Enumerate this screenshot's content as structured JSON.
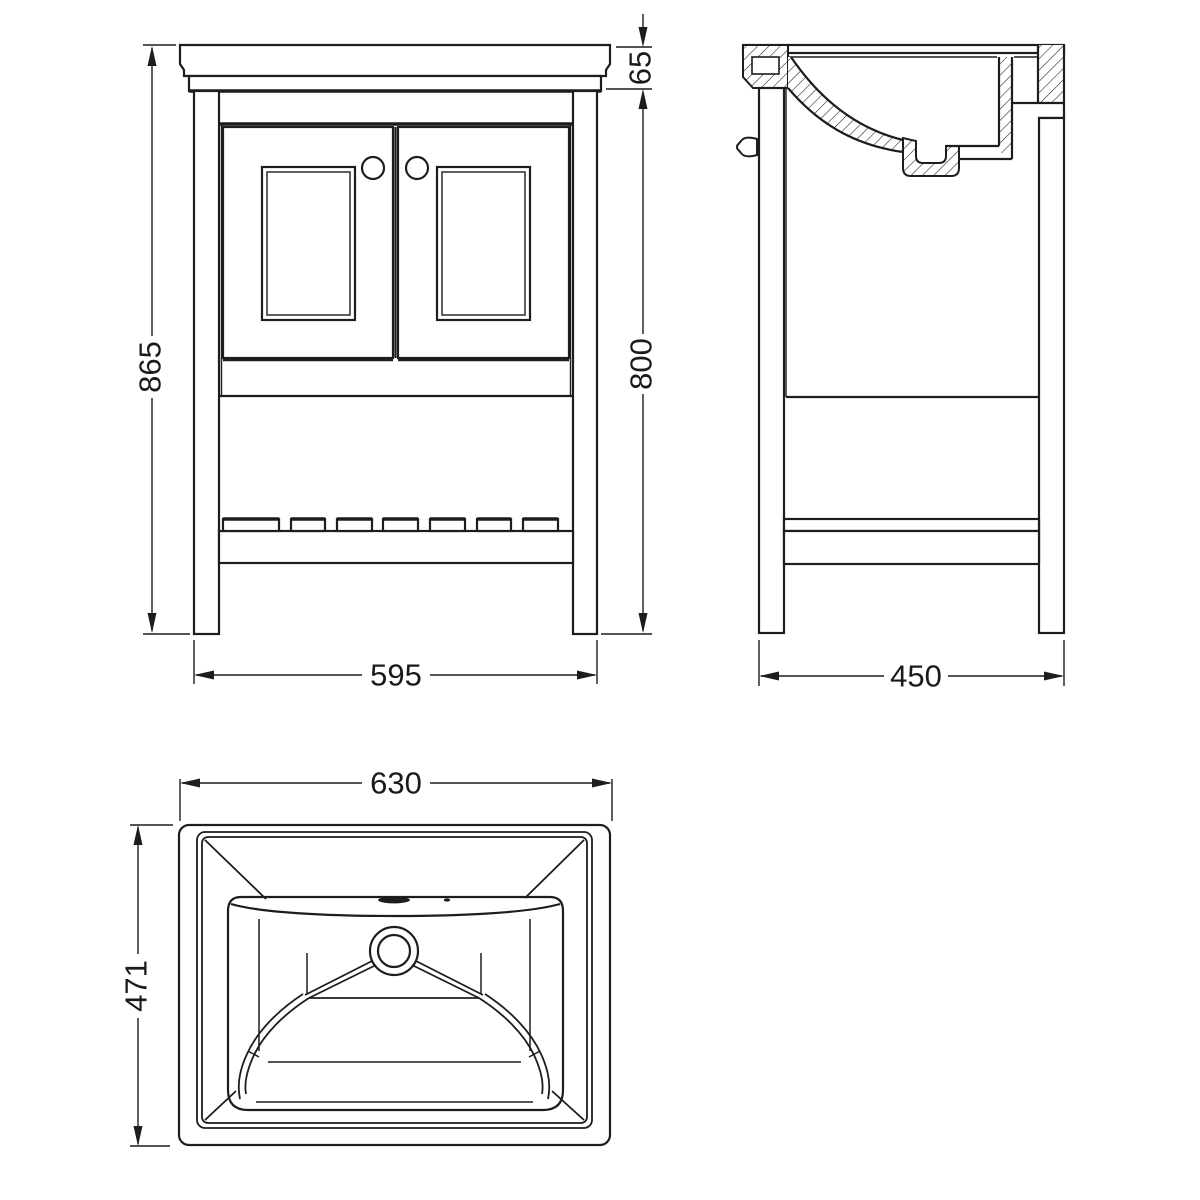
{
  "drawing": {
    "background": "#ffffff",
    "line_color": "#1d1d1f",
    "views": {
      "front": {
        "dim_total_height": "865",
        "dim_worktop_height": "65",
        "dim_carcass_height": "800",
        "dim_width": "595"
      },
      "side": {
        "dim_depth": "450"
      },
      "plan": {
        "dim_width": "630",
        "dim_depth": "471"
      }
    }
  }
}
